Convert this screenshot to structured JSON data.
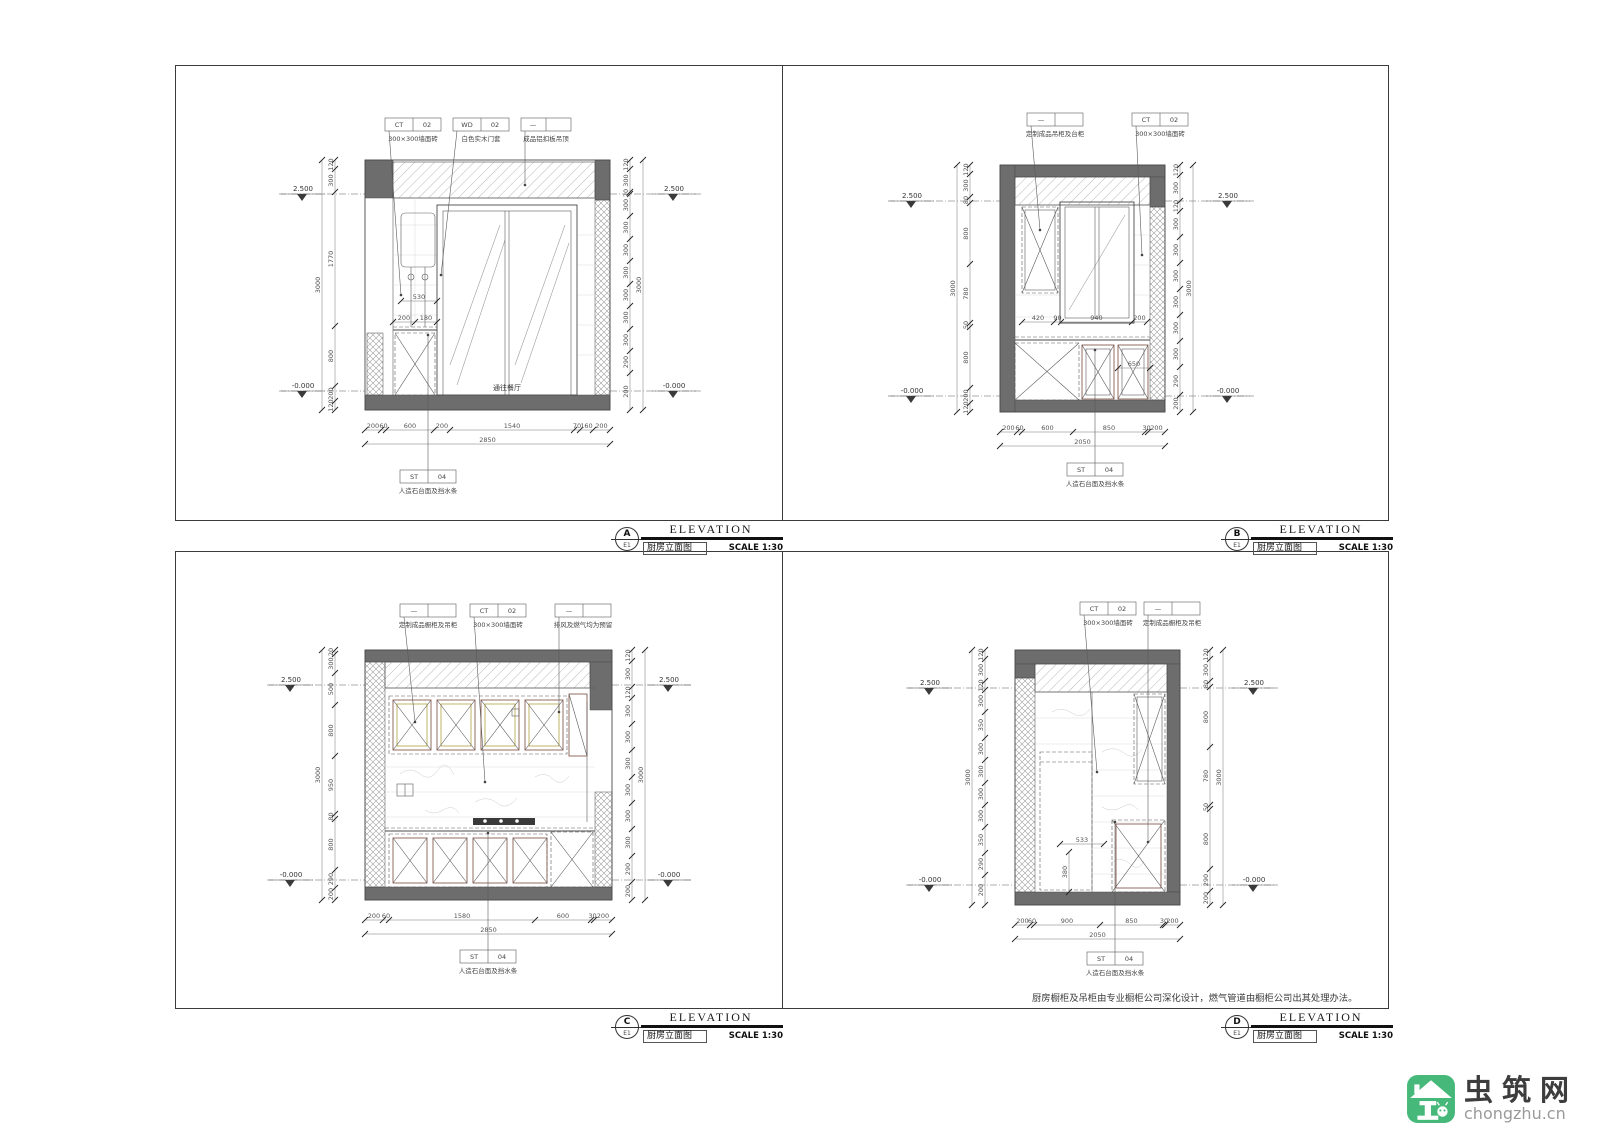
{
  "sheet": {
    "note": "厨房橱柜及吊柜由专业橱柜公司深化设计，燃气管道由橱柜公司出其处理办法。"
  },
  "watermark": {
    "name": "虫筑网",
    "url": "chongzhu.cn",
    "brand_green": "#45b87a"
  },
  "titleblocks": {
    "A": {
      "letter": "A",
      "code": "E1",
      "title_en": "ELEVATION",
      "title_cn": "厨房立面图",
      "scale": "SCALE 1:30"
    },
    "B": {
      "letter": "B",
      "code": "E1",
      "title_en": "ELEVATION",
      "title_cn": "厨房立面图",
      "scale": "SCALE 1:30"
    },
    "C": {
      "letter": "C",
      "code": "E1",
      "title_en": "ELEVATION",
      "title_cn": "厨房立面图",
      "scale": "SCALE 1:30"
    },
    "D": {
      "letter": "D",
      "code": "E1",
      "title_en": "ELEVATION",
      "title_cn": "厨房立面图",
      "scale": "SCALE 1:30"
    }
  },
  "panels": {
    "A": {
      "tags": [
        {
          "c1": "CT",
          "c2": "02",
          "label": "300×300墙面砖"
        },
        {
          "c1": "WD",
          "c2": "02",
          "label": "白色实木门套"
        },
        {
          "c1": "—",
          "c2": "",
          "label": "成品铝扣板吊顶"
        }
      ],
      "tag_bottom": {
        "c1": "ST",
        "c2": "04",
        "label": "人造石台面及挡水条"
      },
      "level_top": "2.500",
      "level_bottom": "-0.000",
      "room_label": "通往餐厅",
      "dims_left": [
        "120",
        "300",
        "1770",
        "800",
        "200",
        "120"
      ],
      "total_left": [
        "3000"
      ],
      "dims_right": [
        "120",
        "300",
        "20",
        "300",
        "300",
        "300",
        "300",
        "300",
        "300",
        "300",
        "290",
        "200"
      ],
      "total_right": [
        "3000"
      ],
      "dims_bottom": [
        "200",
        "60",
        "600",
        "200",
        "1540",
        "70",
        "160",
        "200"
      ],
      "total_bottom": [
        "2850"
      ],
      "dim_heater": [
        "530"
      ],
      "dim_shelf": [
        "200",
        "180"
      ]
    },
    "B": {
      "tags": [
        {
          "c1": "—",
          "c2": "",
          "label": "定制成品吊柜及台柜"
        },
        {
          "c1": "CT",
          "c2": "02",
          "label": "300×300墙面砖"
        }
      ],
      "tag_bottom": {
        "c1": "ST",
        "c2": "04",
        "label": "人造石台面及挡水条"
      },
      "level_top": "2.500",
      "level_bottom": "-0.000",
      "dims_left": [
        "120",
        "300",
        "80",
        "800",
        "780",
        "50",
        "800",
        "200",
        "120"
      ],
      "total_left": [
        "3000"
      ],
      "dims_right": [
        "120",
        "300",
        "120",
        "300",
        "300",
        "300",
        "300",
        "300",
        "300",
        "290",
        "200"
      ],
      "total_right": [
        "3000"
      ],
      "dims_bottom": [
        "200",
        "60",
        "600",
        "850",
        "30",
        "200"
      ],
      "total_bottom": [
        "2050"
      ],
      "dim_row": [
        "420",
        "90",
        "940",
        "200"
      ],
      "dim_cabinet": [
        "650"
      ]
    },
    "C": {
      "tags": [
        {
          "c1": "—",
          "c2": "",
          "label": "定制成品橱柜及吊柜"
        },
        {
          "c1": "CT",
          "c2": "02",
          "label": "300×300墙面砖"
        },
        {
          "c1": "—",
          "c2": "",
          "label": "排风及燃气均为预留"
        }
      ],
      "tag_bottom": {
        "c1": "ST",
        "c2": "04",
        "label": "人造石台面及挡水条"
      },
      "level_top": "2.500",
      "level_bottom": "-0.000",
      "dims_left": [
        "20",
        "300",
        "500",
        "800",
        "950",
        "80",
        "800",
        "290",
        "200"
      ],
      "total_left": [
        "3000"
      ],
      "dims_right": [
        "120",
        "300",
        "120",
        "300",
        "300",
        "300",
        "300",
        "300",
        "300",
        "290",
        "200"
      ],
      "total_right": [
        "3000"
      ],
      "dims_bottom": [
        "200",
        "60",
        "1580",
        "600",
        "30",
        "200"
      ],
      "total_bottom": [
        "2850"
      ]
    },
    "D": {
      "tags": [
        {
          "c1": "CT",
          "c2": "02",
          "label": "300×300墙面砖"
        },
        {
          "c1": "—",
          "c2": "",
          "label": "定制成品橱柜及吊柜"
        }
      ],
      "tag_bottom": {
        "c1": "ST",
        "c2": "04",
        "label": "人造石台面及挡水条"
      },
      "level_top": "2.500",
      "level_bottom": "-0.000",
      "dims_left": [
        "120",
        "300",
        "120",
        "300",
        "350",
        "300",
        "300",
        "300",
        "300",
        "350",
        "290",
        "200"
      ],
      "total_left": [
        "3000"
      ],
      "dims_right": [
        "120",
        "300",
        "80",
        "800",
        "780",
        "50",
        "800",
        "290",
        "200"
      ],
      "total_right": [
        "3000"
      ],
      "dims_bottom": [
        "200",
        "60",
        "900",
        "850",
        "30",
        "200"
      ],
      "total_bottom": [
        "2050"
      ],
      "dim_fridge_w": [
        "533"
      ],
      "dim_fridge_h": [
        "380"
      ]
    }
  }
}
